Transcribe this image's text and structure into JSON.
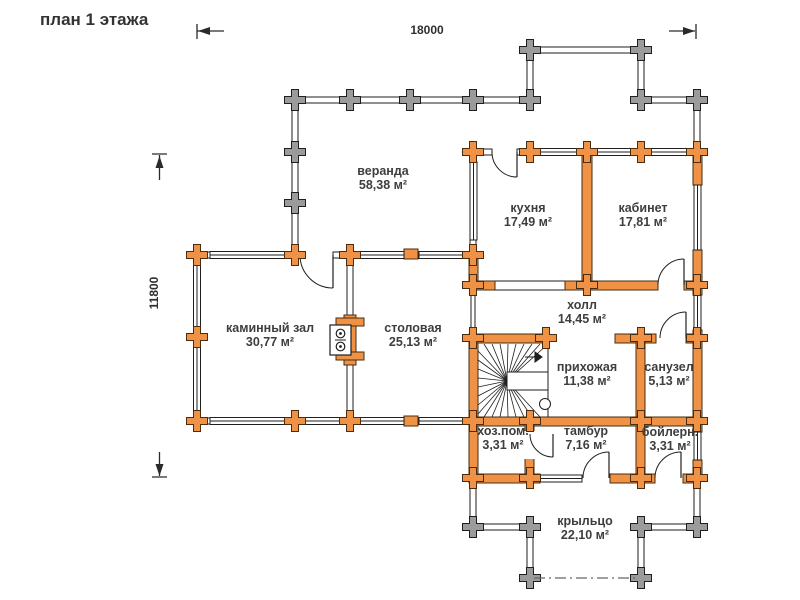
{
  "title": "план 1 этажа",
  "dimensions": {
    "width_label": "18000",
    "height_label": "11800"
  },
  "colors": {
    "warm_wall": "#ef9245",
    "warm_outline": "#4a2c0e",
    "cold_wall": "#9b9b9b",
    "outline": "#1f1f1f",
    "text": "#3e3e3e"
  },
  "rooms": [
    {
      "id": "veranda",
      "name": "веранда",
      "area": "58,38 м²"
    },
    {
      "id": "kitchen",
      "name": "кухня",
      "area": "17,49 м²"
    },
    {
      "id": "office",
      "name": "кабинет",
      "area": "17,81 м²"
    },
    {
      "id": "fireplace-hall",
      "name": "каминный зал",
      "area": "30,77 м²"
    },
    {
      "id": "dining",
      "name": "столовая",
      "area": "25,13 м²"
    },
    {
      "id": "hall",
      "name": "холл",
      "area": "14,45 м²"
    },
    {
      "id": "entry-hall",
      "name": "прихожая",
      "area": "11,38 м²"
    },
    {
      "id": "bathroom",
      "name": "санузел",
      "area": "5,13 м²"
    },
    {
      "id": "utility",
      "name": "хоз.пом.",
      "area": "3,31 м²"
    },
    {
      "id": "tambour",
      "name": "тамбур",
      "area": "7,16 м²"
    },
    {
      "id": "boiler",
      "name": "бойлерн.",
      "area": "3,31 м²"
    },
    {
      "id": "porch",
      "name": "крыльцо",
      "area": "22,10 м²"
    }
  ],
  "symbols": {
    "fireplace": "fireplace-stove-symbol",
    "stairs": "winder-staircase-symbol",
    "porch_edge": "open-edge-dash-dot",
    "log_joint": "log-joint-cross"
  }
}
